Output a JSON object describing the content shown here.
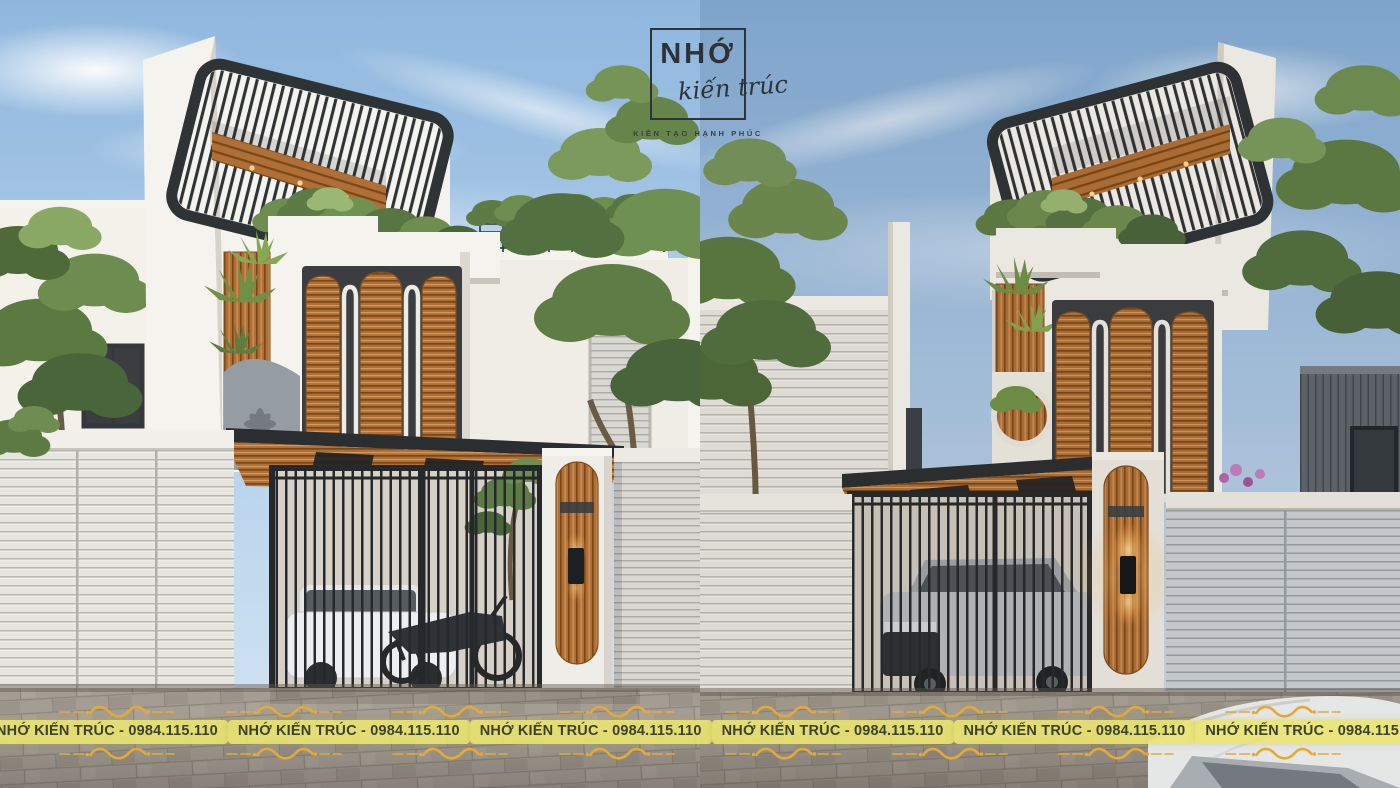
{
  "logo": {
    "brand": "NHỚ",
    "script": "kiến trúc",
    "tagline": "KIẾN TẠO HẠNH PHÚC"
  },
  "watermark": {
    "label": "NHỚ KIẾN TRÚC - 0984.115.110",
    "repeat": 8
  },
  "palette": {
    "sky-top": "#8fb7de",
    "sky-bot": "#d6e7f5",
    "sky-top-r": "#82abd6",
    "sky-bot-r": "#cfdfee",
    "wall": "#f5f3ee",
    "wall-shade": "#ddd9d1",
    "wood": "#b06f36",
    "wood-light": "#d29a5d",
    "wood-dark": "#784818",
    "frame-dark": "#2e3336",
    "gate-dark": "#26292b",
    "window-dark": "#3a3e41",
    "fence": "#e7e5e0",
    "fence-line": "#bcb8b1",
    "fence-blue": "#ccd1d5",
    "fence-blue-line": "#98a0a7",
    "road": "#a49d93",
    "road-line": "#8d867c",
    "leaf": "#5d7c45",
    "leaf-dark": "#49653a",
    "leaf-light": "#93b169",
    "pill-bg": "rgba(234,228,112,0.9)",
    "pill-text": "#3e422d",
    "gold": "#e3ab35",
    "glow": "#ffb54d",
    "ink": "#2e3337"
  }
}
